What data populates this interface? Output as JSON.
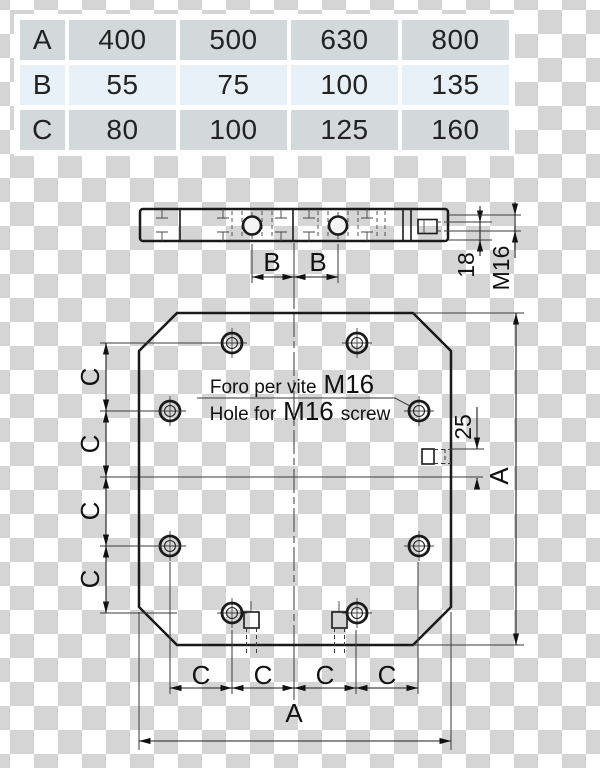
{
  "spec_table": {
    "rows": [
      {
        "label": "A",
        "values": [
          "400",
          "500",
          "630",
          "800"
        ]
      },
      {
        "label": "B",
        "values": [
          "55",
          "75",
          "100",
          "135"
        ]
      },
      {
        "label": "C",
        "values": [
          "80",
          "100",
          "125",
          "160"
        ]
      }
    ]
  },
  "side_view": {
    "dim_b_left": "B",
    "dim_b_right": "B",
    "dim_depth": "18",
    "dim_thread": "M16"
  },
  "plate_view": {
    "note_line1": {
      "text": "Foro per vite",
      "size": "M16"
    },
    "note_line2": {
      "text": "Hole for",
      "size": "M16",
      "tail": "screw"
    },
    "dims_left": [
      "C",
      "C",
      "C",
      "C"
    ],
    "dims_bottom": [
      "C",
      "C",
      "C",
      "C"
    ],
    "dim_width": "A",
    "dim_height": "A",
    "dim_slot": "25"
  },
  "colors": {
    "row_gray": "#d3d8db",
    "row_blue": "#e7f1f7",
    "line_dark": "#1a1a1a",
    "checker_dark": "#d5d5d5",
    "checker_light": "#ffffff"
  }
}
